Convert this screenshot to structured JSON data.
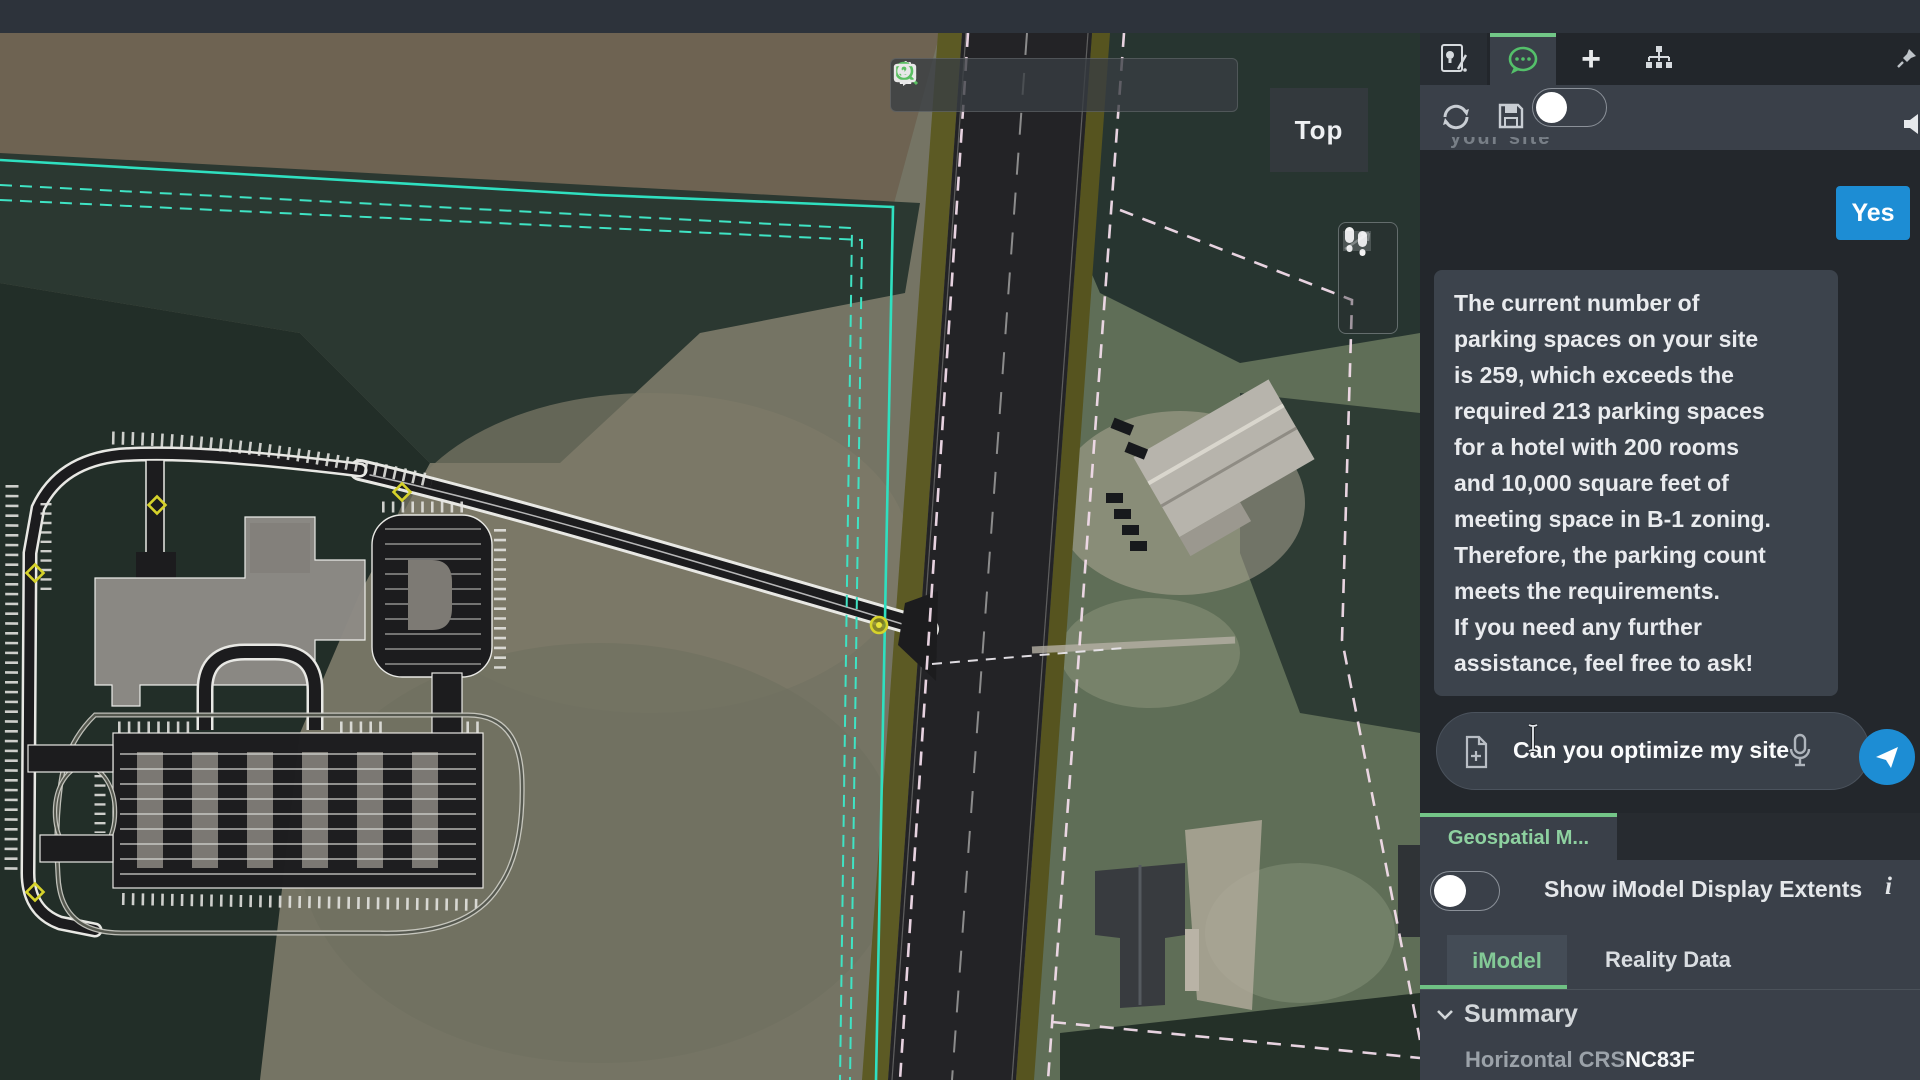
{
  "map": {
    "view_label": "Top",
    "toolbar": {
      "tools": [
        "rotate-view",
        "pan-view",
        "fit-view",
        "zoom-selection",
        "previous-view",
        "next-view"
      ],
      "active_tool": "zoom-selection"
    },
    "walk_toolbar": {
      "tools": [
        "walk",
        "orient-camera"
      ]
    },
    "overlay_colors": {
      "site_boundary_cyan": "#2fe0c0",
      "parcel_line_pink": "#f2dcea",
      "marker_yellow": "#d6d22b"
    }
  },
  "panel": {
    "tabs": [
      {
        "name": "insights"
      },
      {
        "name": "chat",
        "active": true
      },
      {
        "name": "add",
        "glyph": "+"
      },
      {
        "name": "hierarchy"
      }
    ],
    "toolbar": {
      "tools": [
        "refresh",
        "save",
        "record-toggle-off",
        "voice-output"
      ]
    },
    "chat": {
      "clipped_text": "your site",
      "yes_button": "Yes",
      "message": "The current number of\nparking spaces on your site\nis 259, which exceeds the\nrequired 213 parking spaces\nfor a hotel with 200 rooms\nand 10,000 square feet of\nmeeting space in B-1 zoning.\nTherefore, the parking count\nmeets the requirements.\nIf you need any further\nassistance, feel free to ask!",
      "input_value": "Can you optimize my site"
    },
    "geospatial_tab_label": "Geospatial M...",
    "extents": {
      "label": "Show iModel Display Extents",
      "info_glyph": "i",
      "toggle_state": "off"
    },
    "subtabs": [
      {
        "label": "iModel",
        "active": true
      },
      {
        "label": "Reality Data",
        "active": false
      }
    ],
    "summary": {
      "title": "Summary",
      "chevron": "⌄",
      "rows": [
        {
          "label": "Horizontal CRS",
          "value": "NC83F"
        }
      ]
    },
    "accent_green": "#72c787",
    "action_blue": "#1d8dd4"
  }
}
